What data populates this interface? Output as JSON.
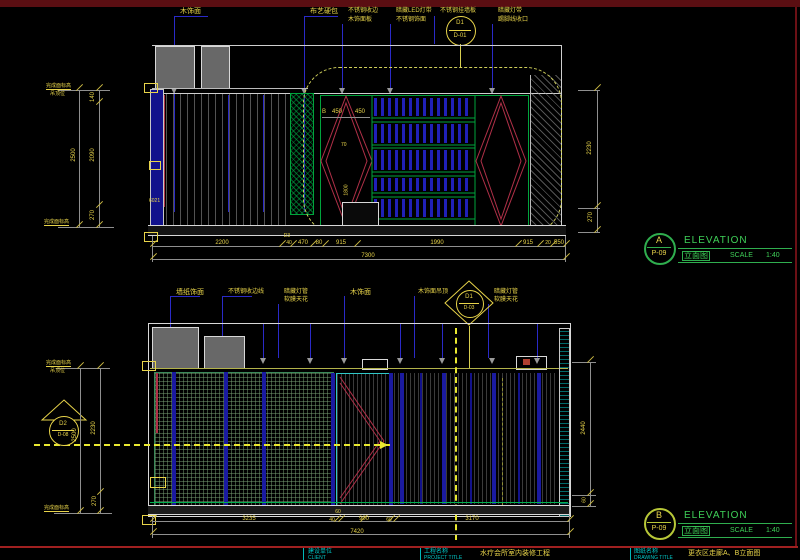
{
  "colors": {
    "band": "#5a0e12",
    "frame_red": "#a02020",
    "yellow": "#e8d44a",
    "blue": "#2a2ac8",
    "green": "#00a43c",
    "cyan": "#00c8c8",
    "red": "#b03048"
  },
  "elev_a": {
    "callouts": [
      {
        "line1": "木饰面",
        "line2": ""
      },
      {
        "line1": "布艺硬包",
        "line2": ""
      },
      {
        "line1": "不锈钢收边",
        "line2": "木饰面板"
      },
      {
        "line1": "暗藏LED灯带",
        "line2": "不锈钢饰面"
      },
      {
        "line1": "不锈钢挂墙板",
        "line2": ""
      },
      {
        "line1": "暗藏灯带",
        "line2": "踢脚线收口"
      }
    ],
    "detail_bubble": {
      "top": "D1",
      "bottom": "D-01"
    },
    "left_dims": {
      "total": "2500",
      "segments": [
        "140",
        "2090",
        "270"
      ],
      "top_label": "完成面标高",
      "top_label2": "吊顶位",
      "bottom_label": "完成面标高"
    },
    "right_dims": [
      "2230",
      "270"
    ],
    "bottom_dims": [
      "2200",
      "40",
      "470",
      "80",
      "915",
      "1990",
      "915",
      "20",
      "550"
    ],
    "bottom_note": "D3",
    "bottom_total": "7300",
    "cabinet_dims": {
      "left": "B",
      "a": "450",
      "b": "450",
      "c": "70",
      "d": "1800"
    },
    "wall_tag": "6021",
    "title": {
      "bubble_letter": "A",
      "bubble_sheet": "P-09",
      "en": "ELEVATION",
      "cn": "立面图",
      "scale_label": "SCALE",
      "scale_value": "1:40"
    }
  },
  "elev_b": {
    "callouts": [
      {
        "line1": "墙纸饰面",
        "line2": ""
      },
      {
        "line1": "不锈钢收边线",
        "line2": ""
      },
      {
        "line1": "暗藏灯管",
        "line2": "软膜天花"
      },
      {
        "line1": "木饰面",
        "line2": ""
      },
      {
        "line1": "木饰面吊顶",
        "line2": ""
      },
      {
        "line1": "暗藏灯管",
        "line2": "软膜天花"
      }
    ],
    "detail_bubble": {
      "top": "D1",
      "bottom": "D-03"
    },
    "side_bubble": {
      "top": "D2",
      "bottom": "D-08"
    },
    "left_dims": {
      "total": "2500",
      "segments": [
        "2230",
        "270"
      ],
      "top_label": "完成面标高",
      "top_label2": "吊顶位",
      "bottom_label": "完成面标高"
    },
    "right_dims": [
      "2440",
      "60"
    ],
    "bottom_dims": [
      "3235",
      "60",
      "40",
      "900",
      "60",
      "3170"
    ],
    "bottom_total": "7420",
    "title": {
      "bubble_letter": "B",
      "bubble_sheet": "P-09",
      "en": "ELEVATION",
      "cn": "立面图",
      "scale_label": "SCALE",
      "scale_value": "1:40"
    }
  },
  "title_bar": {
    "client_cn": "建设单位",
    "client_en": "CLIENT",
    "project_cn": "工程名称",
    "project_en": "PROJECT TITLE",
    "project_value": "水疗会所室内装修工程",
    "drawing_cn": "图纸名称",
    "drawing_en": "DRAWING TITLE",
    "drawing_value": "更衣区走廊A、B立面图"
  }
}
